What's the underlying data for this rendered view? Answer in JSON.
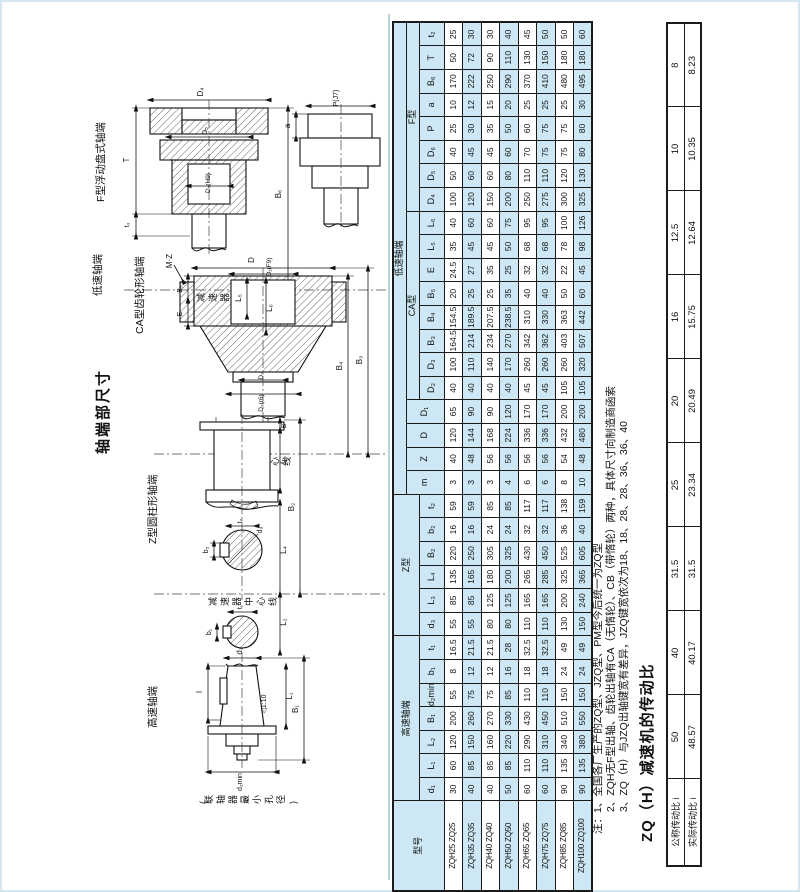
{
  "page_title": "轴端部尺寸",
  "drawings": {
    "centerline_label": "减速器中心线",
    "f_type": {
      "label": "F型浮动盘式轴端",
      "dims": {
        "d4": "D₄",
        "d5": "D₅",
        "d6": "D₆(H9)",
        "t": "T",
        "t3": "t₃",
        "b6": "B₆",
        "a": "a",
        "p": "P(J7)"
      }
    },
    "ca_type": {
      "group_label": "低速轴端",
      "label": "CA型齿轮形轴端",
      "dims": {
        "mz": "M·Z",
        "d": "D",
        "d1": "D₁(F9)",
        "l5": "L₅",
        "l6": "L₆",
        "b5": "B₅",
        "e": "E",
        "d2": "D₂",
        "d3": "D₃(r6)",
        "b4": "B₄",
        "b3": "B₃"
      }
    },
    "z_type": {
      "label": "Z型圆柱形轴端",
      "dims": {
        "b": "B",
        "l3": "L₃",
        "b2": "B₂",
        "l4": "L₄",
        "t2": "t₂",
        "b2k": "b₂",
        "d3": "d₃"
      }
    },
    "hs_type": {
      "label": "高速轴端",
      "caption": "(联轴器最小孔径)",
      "dims": {
        "b1": "b₁",
        "t1": "t₁",
        "l2": "L₂",
        "d1": "d₁",
        "l": "l",
        "taper": "◁1:10",
        "l1": "L₁",
        "b1dim": "B₁",
        "d2min": "d₂min"
      }
    }
  },
  "main_table": {
    "header": {
      "model_label": "型号",
      "groups": [
        {
          "label": "高速轴端",
          "cols": [
            "d₁",
            "L₁",
            "L₂",
            "B₁",
            "d₂min",
            "b₁",
            "t₁"
          ]
        },
        {
          "label": "Z型",
          "cols": [
            "d₃",
            "L₃",
            "L₄",
            "B₂",
            "b₂",
            "t₂"
          ]
        },
        {
          "label": "低速轴端",
          "cols": [
            "m",
            "Z",
            "D",
            "D₁"
          ],
          "subgroups": [
            {
              "label": "CA型",
              "cols": [
                "D₂",
                "D₃",
                "B₃",
                "B₄",
                "B₅",
                "E",
                "L₅",
                "L₆"
              ]
            },
            {
              "label": "F型",
              "cols": [
                "D₄",
                "D₅",
                "D₆",
                "P",
                "a",
                "B₆",
                "T",
                "t₂"
              ]
            }
          ]
        }
      ]
    },
    "rows": [
      {
        "model": "ZQH25 ZQ25",
        "values": [
          30,
          60,
          120,
          200,
          55,
          8,
          16.5,
          55,
          85,
          135,
          220,
          16,
          59,
          3,
          40,
          120,
          65,
          40,
          100,
          164.5,
          154.5,
          20,
          24.5,
          35,
          40,
          100,
          50,
          40,
          25,
          10,
          170,
          50,
          25
        ]
      },
      {
        "model": "ZQH35 ZQ35",
        "values": [
          40,
          85,
          150,
          260,
          75,
          12,
          21.5,
          55,
          85,
          165,
          250,
          16,
          59,
          3,
          48,
          144,
          90,
          40,
          110,
          214,
          189.5,
          25,
          27,
          45,
          60,
          120,
          60,
          45,
          30,
          12,
          222,
          72,
          30
        ]
      },
      {
        "model": "ZQH40 ZQ40",
        "values": [
          40,
          85,
          160,
          270,
          75,
          12,
          21.5,
          80,
          125,
          180,
          305,
          24,
          85,
          3,
          56,
          168,
          90,
          40,
          140,
          234,
          207.5,
          25,
          35,
          45,
          60,
          150,
          60,
          45,
          35,
          15,
          250,
          90,
          30
        ]
      },
      {
        "model": "ZQH50 ZQ50",
        "values": [
          50,
          85,
          220,
          330,
          85,
          16,
          28,
          80,
          125,
          200,
          325,
          24,
          85,
          4,
          56,
          224,
          120,
          40,
          170,
          270,
          238.5,
          35,
          25,
          50,
          75,
          200,
          80,
          60,
          50,
          20,
          290,
          110,
          40
        ]
      },
      {
        "model": "ZQH65 ZQ65",
        "values": [
          60,
          110,
          290,
          430,
          110,
          18,
          32.5,
          110,
          165,
          265,
          430,
          32,
          117,
          6,
          56,
          336,
          170,
          45,
          260,
          342,
          310,
          40,
          32,
          68,
          95,
          250,
          110,
          70,
          60,
          25,
          370,
          130,
          45
        ]
      },
      {
        "model": "ZQH75 ZQ75",
        "values": [
          60,
          110,
          310,
          450,
          110,
          18,
          32.5,
          110,
          165,
          285,
          450,
          32,
          117,
          6,
          56,
          336,
          170,
          45,
          260,
          362,
          330,
          40,
          32,
          68,
          95,
          275,
          110,
          75,
          75,
          25,
          410,
          150,
          50
        ]
      },
      {
        "model": "ZQH85 ZQ85",
        "values": [
          90,
          135,
          340,
          510,
          150,
          24,
          49,
          130,
          200,
          325,
          525,
          36,
          138,
          8,
          54,
          432,
          200,
          105,
          260,
          403,
          363,
          50,
          22,
          78,
          100,
          300,
          120,
          75,
          75,
          25,
          480,
          180,
          50
        ]
      },
      {
        "model": "ZQH100 ZQ100",
        "values": [
          90,
          135,
          380,
          550,
          150,
          24,
          49,
          150,
          240,
          365,
          605,
          40,
          159,
          10,
          48,
          480,
          200,
          105,
          320,
          507,
          442,
          60,
          45,
          98,
          126,
          325,
          130,
          80,
          80,
          30,
          495,
          180,
          60
        ]
      }
    ]
  },
  "notes": [
    "注：1、全国各厂生产的ZQ型、JZQ型、PM型今后统一为ZQ型",
    "2、ZQH无F型出轴、齿轮出轴有CA（无惰轮）、CB（带惰轮）两种，具体尺寸向制造商函索",
    "3、ZQ（H）与JZQ出轴键宽有差异，JZQ键宽依次为18、18、28、28、36、36、40"
  ],
  "ratio_table": {
    "title": "ZQ（H）减速机的传动比",
    "rows": [
      {
        "label": "公称传动比 i",
        "values": [
          "50",
          "40",
          "31.5",
          "25",
          "20",
          "16",
          "12.5",
          "10",
          "8"
        ]
      },
      {
        "label": "实际传动比 i",
        "values": [
          "48.57",
          "40.17",
          "31.5",
          "23.34",
          "20.49",
          "15.75",
          "12.64",
          "10.35",
          "8.23"
        ]
      }
    ]
  }
}
